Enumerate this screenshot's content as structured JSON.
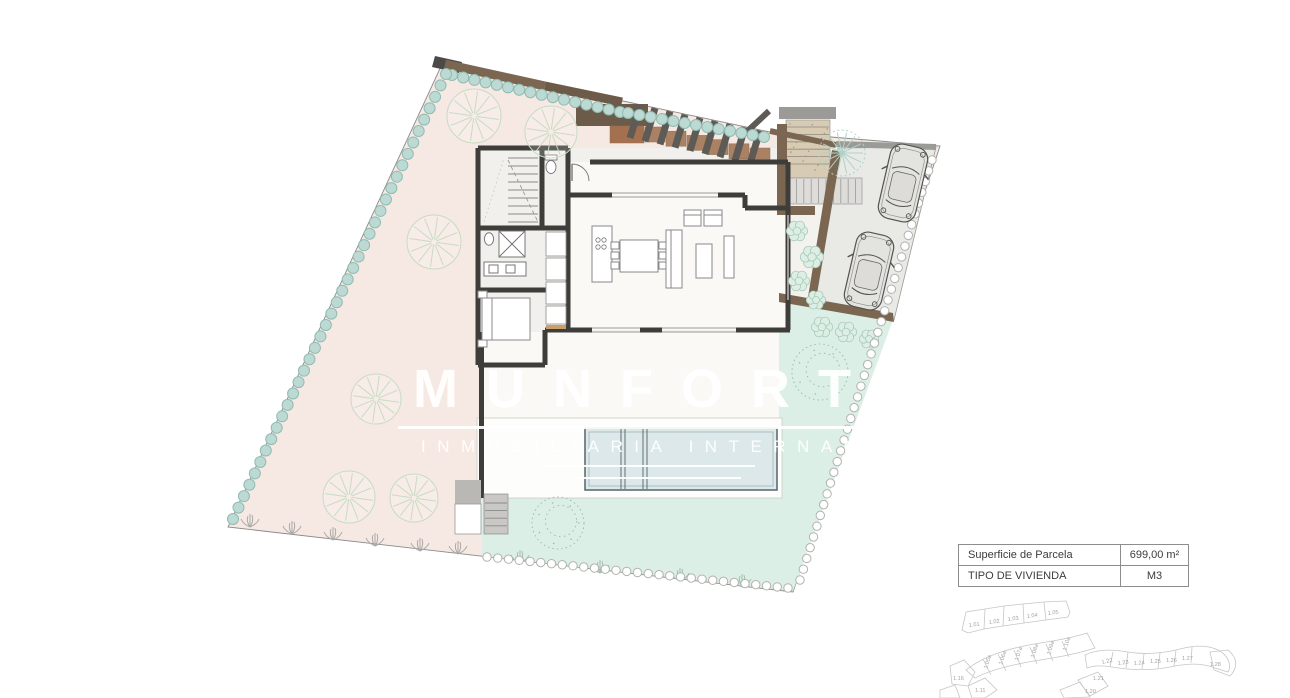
{
  "watermark": {
    "brand": "MUNFORT",
    "tagline": "INMOBILIARIA INTERNACIONAL"
  },
  "info_table": {
    "rows": [
      {
        "label": "Superficie de Parcela",
        "value": "699,00 m²"
      },
      {
        "label": "TIPO DE VIVIENDA",
        "value": "M3"
      }
    ]
  },
  "keyplan": {
    "labels_top": [
      "1.01",
      "1.02",
      "1.03",
      "1.04",
      "1.05"
    ],
    "labels_mid": [
      "1.05a",
      "1.06a",
      "1.07a",
      "1.08a",
      "1.09a",
      "1.10a"
    ],
    "labels_left": [
      "1.16",
      "1.11"
    ],
    "labels_right": [
      "1.22",
      "1.23",
      "1.24",
      "1.25",
      "1.26",
      "1.27",
      "1.28",
      "1.21",
      "1.20"
    ]
  },
  "colors": {
    "garden_pink": "#f6e8e2",
    "lawn_mint": "#dcefe6",
    "hedge_teal": "#bdd9d3",
    "wall_charcoal": "#3f3d3a",
    "wall_brown": "#7a6651",
    "planter_brown": "#ab8164",
    "pool_water": "#dce8ea",
    "driveway_gray": "#e9e9e6"
  }
}
